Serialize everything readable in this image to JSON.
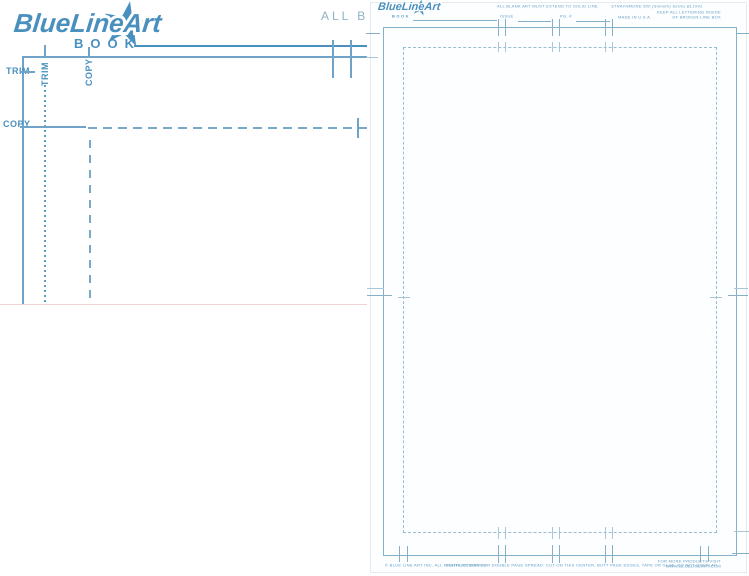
{
  "colors": {
    "accent_blue": "#4a90bf",
    "line_blue": "#6fa3c7",
    "faint_blue": "#a8c6d6",
    "tiny_text_blue": "#5f9cc3"
  },
  "left_board": {
    "brand": "BlueLineArt",
    "product": "BOOK",
    "top_note_partial": "ALL B",
    "trim_label_horizontal": "TRIM",
    "trim_label_vertical": "TRIM",
    "copy_label_vertical": "COPY",
    "copy_label_horizontal": "COPY"
  },
  "right_board": {
    "brand": "BlueLineArt",
    "product": "BOOK",
    "top_center_note": "ALL BLANK ART MUST EXTEND TO SOLID LINE",
    "series_title": "STRATHMORE 500 (Smooth) Series BL1041",
    "issue_label": "ISSUE",
    "page_label": "PG. #",
    "made_in": "MADE IN U.S.A.",
    "lettering_note_1": "KEEP ALL LETTERING INSIDE",
    "lettering_note_2": "OF BROKEN-LINE BOX",
    "bottom_left_note": "© BLUE LINE ART INC. ALL RIGHTS RESERVED",
    "bottom_center_note": "INSTRUCTIONS FOR DOUBLE PAGE SPREAD: CUT ON THIS CENTER, BUTT PAGE EDGES, TAPE OR GLUE. DO NOT OVERLAP.",
    "bottom_right_note_1": "FOR MORE PRODUCTS VISIT",
    "bottom_right_note_2": "WWW.BLUELINEART.COM"
  }
}
